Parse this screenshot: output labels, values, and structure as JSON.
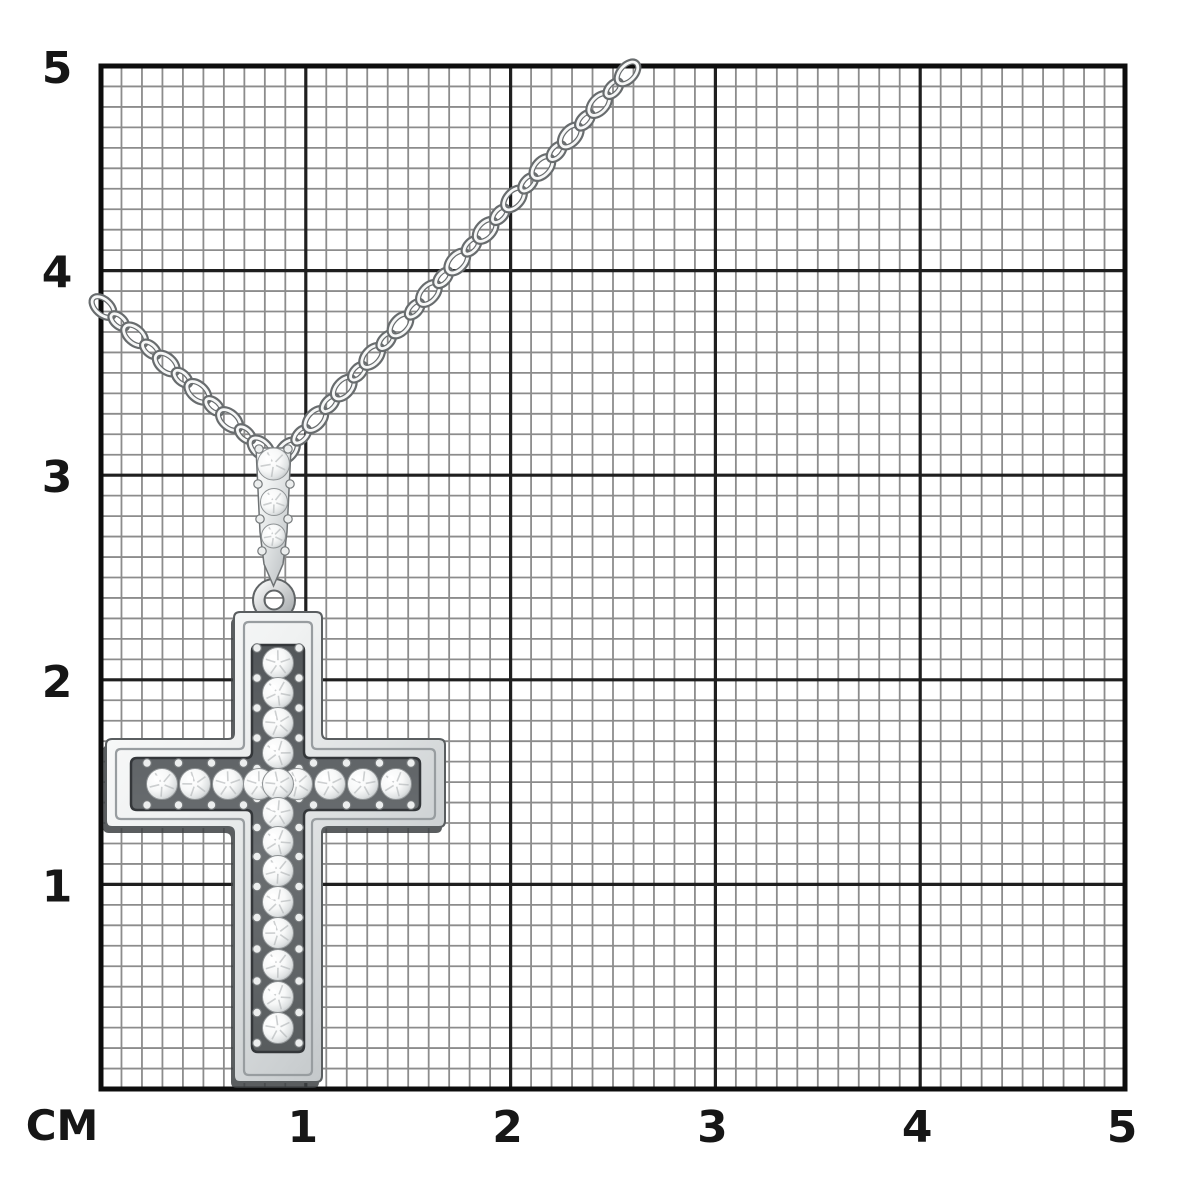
{
  "meta": {
    "subject": "white-gold diamond cross pendant with cable chain photographed on a centimeter measuring grid",
    "background": "#ffffff"
  },
  "grid": {
    "unit_label": "CM",
    "cm_count": 5,
    "minor_per_cm": 10,
    "area": {
      "left": 101,
      "top": 66,
      "right": 1125,
      "bottom": 1089
    },
    "colors": {
      "minor": "#8c8c8c",
      "major": "#1f1f1f",
      "border": "#0d0d0d",
      "label": "#161616",
      "background": "#ffffff"
    },
    "stroke": {
      "minor": 1.8,
      "major": 3.2,
      "border": 5
    },
    "y_labels": [
      {
        "text": "5",
        "cm": 5
      },
      {
        "text": "4",
        "cm": 4
      },
      {
        "text": "3",
        "cm": 3
      },
      {
        "text": "2",
        "cm": 2
      },
      {
        "text": "1",
        "cm": 1
      }
    ],
    "x_labels": [
      {
        "text": "1",
        "cm": 1
      },
      {
        "text": "2",
        "cm": 2
      },
      {
        "text": "3",
        "cm": 3
      },
      {
        "text": "4",
        "cm": 4
      },
      {
        "text": "5",
        "cm": 5
      }
    ],
    "unit_label_pos": {
      "x": 62,
      "y": 1140
    },
    "x_label_baseline": 1142,
    "y_label_x": 57
  },
  "necklace": {
    "metal": {
      "light": "#fdfdfd",
      "mid": "#dde0e1",
      "deep": "#b2b6b8",
      "outline": "#5a5e60",
      "dark": "#3d4143",
      "step": "#989da0"
    },
    "gem": {
      "center": "#ffffff",
      "edge": "#bcc0c2",
      "stroke": "#8e9294",
      "facet": "#aeb2b4"
    },
    "chain": {
      "left_strand": {
        "x1": 103,
        "y1": 307,
        "x2": 263,
        "y2": 450
      },
      "right_strand": {
        "x1": 287,
        "y1": 451,
        "x2": 641,
        "y2": 58
      },
      "link_step": 21.2,
      "wide": {
        "rx": 13.5,
        "ry": 8
      },
      "narrow": {
        "rx": 10,
        "ry": 5.5
      },
      "stroke_dark": "#686c6e",
      "stroke_light": "#f6f7f7"
    },
    "bail": {
      "body_path": "M256,448 L291,448 L287,532 L283,564 L273.5,586 L264,564 L260,532 Z",
      "stones": [
        {
          "x": 273.5,
          "y": 464,
          "r": 16
        },
        {
          "x": 274,
          "y": 502,
          "r": 13.5
        },
        {
          "x": 273.5,
          "y": 536,
          "r": 12
        }
      ],
      "prongs": [
        [
          259,
          449
        ],
        [
          288,
          449
        ],
        [
          258,
          484
        ],
        [
          290,
          484
        ],
        [
          260,
          519
        ],
        [
          288,
          519
        ],
        [
          262,
          551
        ],
        [
          285,
          551
        ]
      ]
    },
    "ring": {
      "cx": 274,
      "cy": 600,
      "outer_r": 21,
      "inner_r": 9.5
    },
    "cross": {
      "outer": {
        "vx": [
          234,
          322
        ],
        "vy": [
          612,
          1082
        ],
        "hx": [
          106,
          445
        ],
        "hy": [
          739,
          827
        ]
      },
      "step": {
        "vx": [
          244,
          312
        ],
        "vy": [
          622,
          1075
        ],
        "hx": [
          116,
          435
        ],
        "hy": [
          749,
          819
        ]
      },
      "channel": {
        "vx": [
          252,
          304
        ],
        "vy": [
          645,
          1052
        ],
        "hx": [
          131,
          420
        ],
        "hy": [
          758,
          810
        ]
      },
      "column_x": 278,
      "row_y": 784,
      "stone_r": 15.5,
      "column_stone_ys": [
        663,
        693,
        723,
        753,
        784,
        813,
        842,
        871,
        902,
        933,
        965,
        997,
        1028
      ],
      "row_stone_xs": [
        162,
        195,
        228,
        259,
        297,
        330,
        363,
        396
      ],
      "bead_r": 4.3,
      "bead_offset": 21
    }
  }
}
